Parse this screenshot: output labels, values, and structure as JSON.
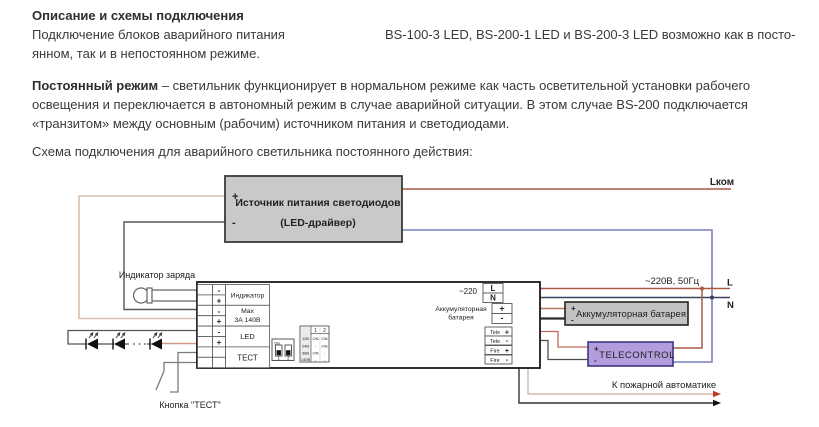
{
  "text": {
    "heading": "Описание и схемы подключения",
    "p1_line1_before": "Подключение блоков аварийного питания",
    "p1_line1_after": "BS-100-3 LED, BS-200-1 LED и BS-200-3 LED возможно как в посто-",
    "p1_line2": "янном, так и в непостоянном режиме.",
    "p2_lead": "Постоянный режим",
    "p2_line1_rest": " – светильник функционирует в нормальном режиме как часть осветительной установки рабочего",
    "p2_line2": "освещения и переключается в автономный режим в случае аварийной ситуации. В этом случае BS-200 подключается",
    "p2_line3": "«транзитом» между основным (рабочим) источником питания и светодиодами.",
    "p3": "Схема подключения для аварийного светильника постоянного действия:"
  },
  "diagram": {
    "driver_box": {
      "title": "Источник питания светодиодов",
      "subtitle": "(LED-драйвер)",
      "plus": "+",
      "minus": "-"
    },
    "net": {
      "lkom": "Lком",
      "mains": "~220В, 50Гц",
      "l": "L",
      "n": "N"
    },
    "left": {
      "charge_indicator": "Индикатор заряда",
      "test_button": "Кнопка \"ТЕСТ\""
    },
    "unit": {
      "rows": [
        {
          "minus": "-",
          "plus": "+",
          "label1": "Индикатор",
          "label2": ""
        },
        {
          "minus": "-",
          "plus": "+",
          "label1": "Max",
          "label2": "3А  140В"
        },
        {
          "minus": "-",
          "plus": "+",
          "label1": "LED",
          "label2": ""
        },
        {
          "minus": "",
          "plus": "",
          "label1": "ТЕСТ",
          "label2": ""
        }
      ],
      "mains_label": "~220",
      "l": "L",
      "n": "N",
      "battery_label1": "Аккумуляторная",
      "battery_label2": "батарея",
      "battery_plus": "+",
      "battery_minus": "-",
      "tele_label": "Tele",
      "fire_label": "Fire",
      "plus": "+",
      "minus": "-",
      "dip": {
        "on": "ON",
        "sw1": "1",
        "sw2": "2",
        "table": {
          "h1": "1",
          "h2": "2",
          "rows": [
            [
              "12В",
              "ON",
              "ON"
            ],
            [
              "24В",
              "-",
              "ON"
            ],
            [
              "36В",
              "ON",
              "-"
            ],
            [
              "140В",
              "-",
              "-"
            ]
          ]
        }
      }
    },
    "battery_box": {
      "label": "Аккумуляторная батарея",
      "plus": "+",
      "minus": "-"
    },
    "telecontrol_box": {
      "label": "TELECONTROL",
      "plus": "+",
      "minus": "-"
    },
    "fire_out_label": "К пожарной автоматике"
  },
  "colors": {
    "wire_live_brown": "#a85a45",
    "wire_neutral_navy": "#3d4263",
    "wire_blue": "#7b80c0",
    "wire_tan": "#dcbfae",
    "wire_dark": "#555555",
    "plus_red": "#cc2a1a",
    "terminal_letter_blue": "#3949ab",
    "driver_fill": "#c9c9c9",
    "battery_fill": "#c2c2c2",
    "telecontrol_fill": "#b49ddd"
  }
}
